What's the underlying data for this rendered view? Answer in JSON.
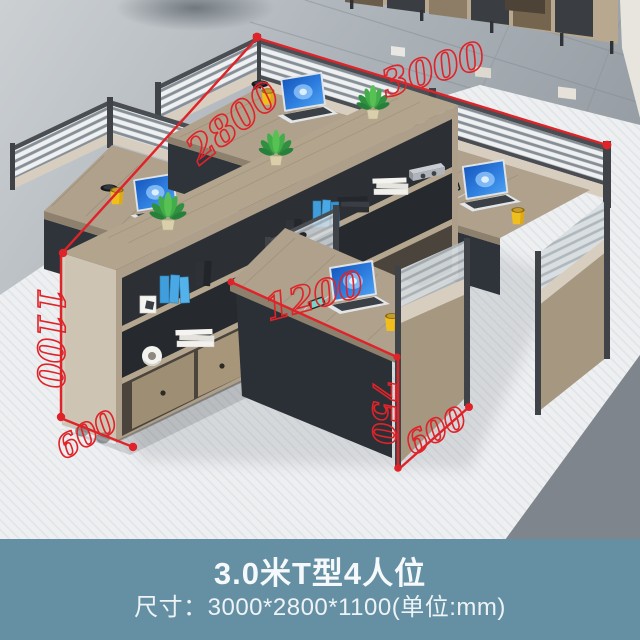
{
  "image": {
    "description": "T-shaped 4-person office workstation render with red dimension annotations",
    "dims": {
      "d3000": "3000",
      "d2800": "2800",
      "d1200": "1200",
      "d1100": "1100",
      "d750": "750",
      "d600_left": "600",
      "d600_right": "600"
    }
  },
  "caption": {
    "title": "3.0米T型4人位",
    "size_line": "尺寸：3000*2800*1100(单位:mm)"
  },
  "colors": {
    "annotation_red": "#df2329",
    "banner_blue": "#6590a3",
    "desk_wood": "#b0a18c",
    "panel_beige": "#cdc4b4",
    "frame_dark": "#43474c",
    "rug_white": "#edeff1",
    "laptop_screen_blue": "#2f7fe0",
    "cup_yellow": "#f0bf1e",
    "plant_green": "#3aa145"
  }
}
